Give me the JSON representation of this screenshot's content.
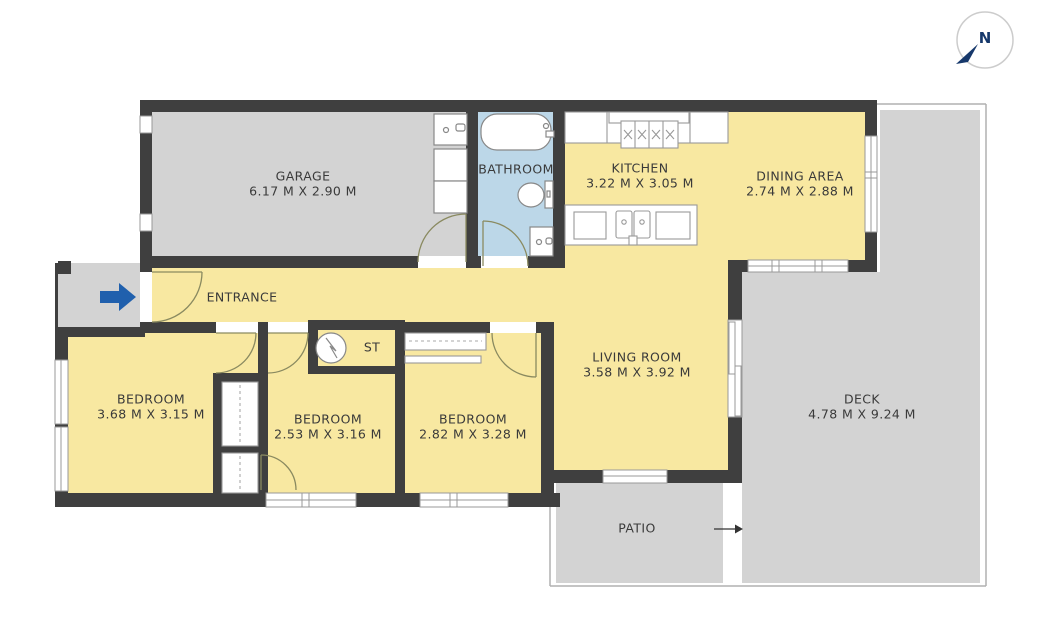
{
  "compass": {
    "north_label": "N"
  },
  "rooms": {
    "garage": {
      "name": "GARAGE",
      "dims": "6.17 M X 2.90 M"
    },
    "bathroom": {
      "name": "BATHROOM"
    },
    "kitchen": {
      "name": "KITCHEN",
      "dims": "3.22 M X 3.05 M"
    },
    "dining": {
      "name": "DINING AREA",
      "dims": "2.74 M X 2.88 M"
    },
    "entrance": {
      "name": "ENTRANCE"
    },
    "storage": {
      "name": "ST"
    },
    "living": {
      "name": "LIVING ROOM",
      "dims": "3.58 M X 3.92 M"
    },
    "bedroom1": {
      "name": "BEDROOM",
      "dims": "3.68 M X 3.15 M"
    },
    "bedroom2": {
      "name": "BEDROOM",
      "dims": "2.53 M X 3.16 M"
    },
    "bedroom3": {
      "name": "BEDROOM",
      "dims": "2.82 M X 3.28 M"
    },
    "deck": {
      "name": "DECK",
      "dims": "4.78 M X 9.24 M"
    },
    "patio": {
      "name": "PATIO"
    }
  },
  "colors": {
    "wall": "#3f3f3f",
    "room_yellow": "#f8e8a1",
    "outdoor_gray": "#d3d3d3",
    "bathroom_blue": "#bcd7e8",
    "accent_blue": "#2060ad",
    "compass_navy": "#16386b",
    "outline_gray": "#b0b0b0"
  }
}
